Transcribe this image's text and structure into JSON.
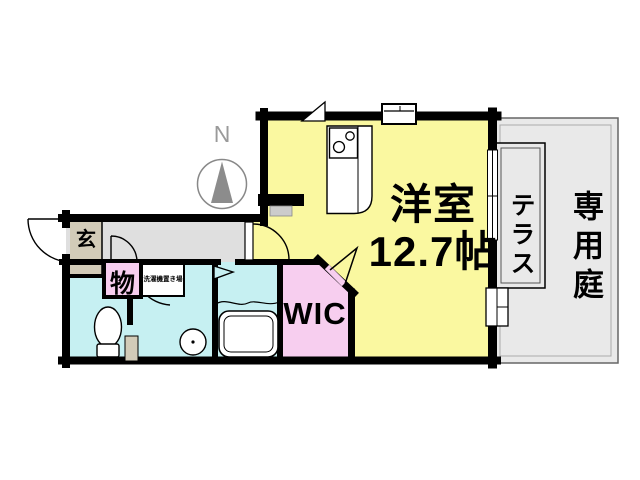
{
  "plan": {
    "compass_label": "N",
    "rooms": {
      "main": {
        "name": "洋室",
        "size": "12.7帖"
      },
      "wic": {
        "label": "WIC"
      },
      "terrace": {
        "label": "テラス"
      },
      "garden": {
        "label": "専用庭"
      },
      "entrance": {
        "label": "玄"
      },
      "storage": {
        "label": "物"
      },
      "laundry": {
        "label": "洗濯機置き場"
      }
    },
    "colors": {
      "main_room": "#FAF8A0",
      "wet_rooms": "#C6F0F2",
      "closet_pink": "#F7CEEF",
      "corridor": "#DFDFDF",
      "entrance_floor": "#D2CBB8",
      "garden": "#E9E9E9",
      "wall": "#000000"
    }
  }
}
